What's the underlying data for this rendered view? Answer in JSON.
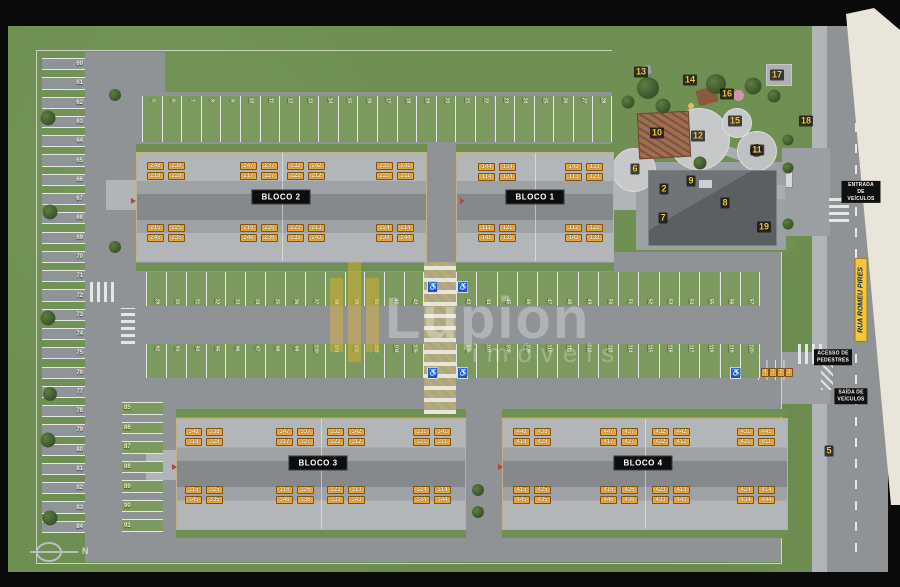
{
  "watermark": {
    "line1": "Lupion",
    "line2": "imóveis"
  },
  "compass": {
    "label": "N"
  },
  "street": {
    "name": "RUA ROMEU PIRES"
  },
  "road_labels": {
    "entrance": "ENTRADA\nDE VEÍCULOS",
    "pedestrian": "ACESSO DE\nPEDESTRES",
    "exit": "SAÍDA DE\nVEÍCULOS"
  },
  "icons": {
    "accessible": "♿",
    "tree": "tree-icon",
    "compass": "compass-icon"
  },
  "palette": {
    "grass": "#6e8f51",
    "pavement": "#8f9396",
    "stall_green": "#7d9a5e",
    "stall_gray": "#8f9499",
    "chip_bg": "#eca43c",
    "marker_text": "#f8c93e",
    "sign_bg": "#1c56bd",
    "accent_yellow": "#f3c73e",
    "cream": "#e9e5da",
    "block_label_bg": "#0d0d0d"
  },
  "blocks": [
    {
      "label": "BLOCO 2",
      "x": 136,
      "y": 152,
      "w": 291,
      "h": 110,
      "label_cx": 281,
      "label_cy": 197,
      "groups": [
        {
          "x": 147,
          "y": 162,
          "rows": [
            [
              "248",
              "238"
            ],
            [
              "218",
              "228"
            ]
          ]
        },
        {
          "x": 240,
          "y": 162,
          "rows": [
            [
              "247",
              "237"
            ],
            [
              "217",
              "227"
            ]
          ]
        },
        {
          "x": 287,
          "y": 162,
          "rows": [
            [
              "232",
              "242"
            ],
            [
              "222",
              "212"
            ]
          ]
        },
        {
          "x": 376,
          "y": 162,
          "rows": [
            [
              "231",
              "241"
            ],
            [
              "221",
              "211"
            ]
          ]
        },
        {
          "x": 147,
          "y": 224,
          "rows": [
            [
              "215",
              "225"
            ],
            [
              "245",
              "235"
            ]
          ]
        },
        {
          "x": 240,
          "y": 224,
          "rows": [
            [
              "216",
              "226"
            ],
            [
              "246",
              "236"
            ]
          ]
        },
        {
          "x": 287,
          "y": 224,
          "rows": [
            [
              "223",
              "213"
            ],
            [
              "233",
              "243"
            ]
          ]
        },
        {
          "x": 376,
          "y": 224,
          "rows": [
            [
              "224",
              "214"
            ],
            [
              "234",
              "244"
            ]
          ]
        }
      ]
    },
    {
      "label": "BLOCO 1",
      "x": 456,
      "y": 152,
      "w": 158,
      "h": 110,
      "label_cx": 535,
      "label_cy": 197,
      "groups": [
        {
          "x": 478,
          "y": 163,
          "rows": [
            [
              "144",
              "134"
            ],
            [
              "114",
              "124"
            ]
          ]
        },
        {
          "x": 565,
          "y": 163,
          "rows": [
            [
              "143",
              "133"
            ],
            [
              "113",
              "123"
            ]
          ]
        },
        {
          "x": 478,
          "y": 224,
          "rows": [
            [
              "111",
              "121"
            ],
            [
              "141",
              "131"
            ]
          ]
        },
        {
          "x": 565,
          "y": 224,
          "rows": [
            [
              "112",
              "122"
            ],
            [
              "142",
              "132"
            ]
          ]
        }
      ]
    },
    {
      "label": "BLOCO 3",
      "x": 176,
      "y": 418,
      "w": 290,
      "h": 112,
      "label_cx": 318,
      "label_cy": 463,
      "groups": [
        {
          "x": 185,
          "y": 428,
          "rows": [
            [
              "348",
              "338"
            ],
            [
              "318",
              "328"
            ]
          ]
        },
        {
          "x": 276,
          "y": 428,
          "rows": [
            [
              "347",
              "337"
            ],
            [
              "317",
              "327"
            ]
          ]
        },
        {
          "x": 327,
          "y": 428,
          "rows": [
            [
              "332",
              "342"
            ],
            [
              "322",
              "312"
            ]
          ]
        },
        {
          "x": 413,
          "y": 428,
          "rows": [
            [
              "331",
              "341"
            ],
            [
              "321",
              "311"
            ]
          ]
        },
        {
          "x": 185,
          "y": 486,
          "rows": [
            [
              "315",
              "325"
            ],
            [
              "345",
              "335"
            ]
          ]
        },
        {
          "x": 276,
          "y": 486,
          "rows": [
            [
              "316",
              "326"
            ],
            [
              "346",
              "336"
            ]
          ]
        },
        {
          "x": 327,
          "y": 486,
          "rows": [
            [
              "323",
              "313"
            ],
            [
              "333",
              "343"
            ]
          ]
        },
        {
          "x": 413,
          "y": 486,
          "rows": [
            [
              "324",
              "314"
            ],
            [
              "334",
              "344"
            ]
          ]
        }
      ]
    },
    {
      "label": "BLOCO 4",
      "x": 502,
      "y": 418,
      "w": 286,
      "h": 112,
      "label_cx": 643,
      "label_cy": 463,
      "groups": [
        {
          "x": 513,
          "y": 428,
          "rows": [
            [
              "448",
              "438"
            ],
            [
              "418",
              "428"
            ]
          ]
        },
        {
          "x": 600,
          "y": 428,
          "rows": [
            [
              "447",
              "437"
            ],
            [
              "417",
              "427"
            ]
          ]
        },
        {
          "x": 652,
          "y": 428,
          "rows": [
            [
              "432",
              "442"
            ],
            [
              "422",
              "412"
            ]
          ]
        },
        {
          "x": 737,
          "y": 428,
          "rows": [
            [
              "431",
              "441"
            ],
            [
              "421",
              "411"
            ]
          ]
        },
        {
          "x": 513,
          "y": 486,
          "rows": [
            [
              "415",
              "425"
            ],
            [
              "445",
              "435"
            ]
          ]
        },
        {
          "x": 600,
          "y": 486,
          "rows": [
            [
              "416",
              "426"
            ],
            [
              "446",
              "436"
            ]
          ]
        },
        {
          "x": 652,
          "y": 486,
          "rows": [
            [
              "423",
              "413"
            ],
            [
              "433",
              "443"
            ]
          ]
        },
        {
          "x": 737,
          "y": 486,
          "rows": [
            [
              "424",
              "414"
            ],
            [
              "434",
              "444"
            ]
          ]
        }
      ]
    }
  ],
  "parking": {
    "rows": [
      {
        "id": "left-column",
        "dir": "h",
        "x": 42,
        "y": 58,
        "w": 43,
        "h": 482,
        "num_side": "right",
        "fill": "#8f9499",
        "numbers": [
          "60",
          "61",
          "62",
          "63",
          "64",
          "65",
          "66",
          "67",
          "68",
          "69",
          "70",
          "71",
          "72",
          "73",
          "74",
          "75",
          "76",
          "77",
          "78",
          "79",
          "80",
          "81",
          "82",
          "83",
          "84"
        ]
      },
      {
        "id": "inner-column",
        "dir": "h",
        "x": 122,
        "y": 402,
        "w": 41,
        "h": 137,
        "num_side": "left",
        "fill": "#7d9a5e",
        "numbers": [
          "85",
          "86",
          "87",
          "88",
          "89",
          "90",
          "91"
        ]
      },
      {
        "id": "top-row",
        "dir": "v",
        "x": 142,
        "y": 96,
        "w": 470,
        "h": 46,
        "num_side": "top",
        "fill": "#7d9a5e",
        "numbers": [
          "5",
          "6",
          "7",
          "8",
          "9",
          "10",
          "11",
          "12",
          "13",
          "14",
          "15",
          "16",
          "17",
          "18",
          "19",
          "20",
          "21",
          "22",
          "23",
          "24",
          "25",
          "26",
          "27",
          "28"
        ]
      },
      {
        "id": "middle-top-west",
        "dir": "v",
        "x": 146,
        "y": 272,
        "w": 278,
        "h": 34,
        "num_side": "bottom",
        "fill": "#7d9a5e",
        "numbers": [
          "29",
          "30",
          "31",
          "32",
          "33",
          "34",
          "35",
          "36",
          "37",
          "38",
          "39",
          "40",
          "41",
          "42"
        ]
      },
      {
        "id": "middle-top-east",
        "dir": "v",
        "x": 456,
        "y": 272,
        "w": 304,
        "h": 34,
        "num_side": "bottom",
        "fill": "#7d9a5e",
        "numbers": [
          "43",
          "44",
          "45",
          "46",
          "47",
          "48",
          "49",
          "50",
          "51",
          "52",
          "53",
          "54",
          "55",
          "56",
          "57"
        ]
      },
      {
        "id": "middle-bottom-west",
        "dir": "v",
        "x": 146,
        "y": 344,
        "w": 278,
        "h": 34,
        "num_side": "top",
        "fill": "#7d9a5e",
        "numbers": [
          "92",
          "93",
          "94",
          "95",
          "96",
          "97",
          "98",
          "99",
          "100",
          "101",
          "102",
          "103",
          "104",
          "105"
        ]
      },
      {
        "id": "middle-bottom-east",
        "dir": "v",
        "x": 456,
        "y": 344,
        "w": 304,
        "h": 34,
        "num_side": "top",
        "fill": "#7d9a5e",
        "numbers": [
          "106",
          "107",
          "108",
          "109",
          "110",
          "111",
          "112",
          "113",
          "114",
          "115",
          "116",
          "117",
          "118",
          "119",
          "120"
        ]
      }
    ],
    "visitor": {
      "y": 368,
      "xs": [
        761,
        769,
        777,
        785
      ],
      "numbers": [
        "4",
        "3",
        "2",
        "1"
      ]
    }
  },
  "markers": [
    {
      "n": "2",
      "x": 664,
      "y": 189
    },
    {
      "n": "5",
      "x": 829,
      "y": 451
    },
    {
      "n": "6",
      "x": 635,
      "y": 169
    },
    {
      "n": "7",
      "x": 663,
      "y": 218
    },
    {
      "n": "8",
      "x": 725,
      "y": 203
    },
    {
      "n": "9",
      "x": 691,
      "y": 181
    },
    {
      "n": "10",
      "x": 657,
      "y": 133
    },
    {
      "n": "11",
      "x": 757,
      "y": 150
    },
    {
      "n": "12",
      "x": 698,
      "y": 136
    },
    {
      "n": "13",
      "x": 641,
      "y": 72
    },
    {
      "n": "14",
      "x": 690,
      "y": 80
    },
    {
      "n": "15",
      "x": 735,
      "y": 121
    },
    {
      "n": "16",
      "x": 727,
      "y": 94
    },
    {
      "n": "17",
      "x": 777,
      "y": 75
    },
    {
      "n": "18",
      "x": 806,
      "y": 121
    },
    {
      "n": "19",
      "x": 764,
      "y": 227
    }
  ],
  "signs": [
    {
      "x": 427,
      "y": 281
    },
    {
      "x": 457,
      "y": 281
    },
    {
      "x": 427,
      "y": 367
    },
    {
      "x": 457,
      "y": 367
    },
    {
      "x": 730,
      "y": 367
    }
  ],
  "trees": [
    [
      48,
      118,
      15
    ],
    [
      50,
      212,
      15
    ],
    [
      48,
      318,
      15
    ],
    [
      50,
      394,
      14
    ],
    [
      48,
      440,
      15
    ],
    [
      50,
      518,
      15
    ],
    [
      115,
      95,
      12
    ],
    [
      115,
      247,
      12
    ],
    [
      648,
      88,
      22
    ],
    [
      663,
      106,
      15
    ],
    [
      716,
      84,
      20
    ],
    [
      753,
      86,
      17
    ],
    [
      774,
      96,
      13
    ],
    [
      700,
      163,
      13
    ],
    [
      628,
      102,
      13
    ],
    [
      788,
      140,
      11
    ],
    [
      788,
      168,
      11
    ],
    [
      788,
      224,
      11
    ],
    [
      478,
      490,
      12
    ],
    [
      478,
      512,
      12
    ]
  ],
  "arrows": [
    [
      131,
      198
    ],
    [
      460,
      198
    ],
    [
      172,
      464
    ],
    [
      498,
      464
    ]
  ]
}
